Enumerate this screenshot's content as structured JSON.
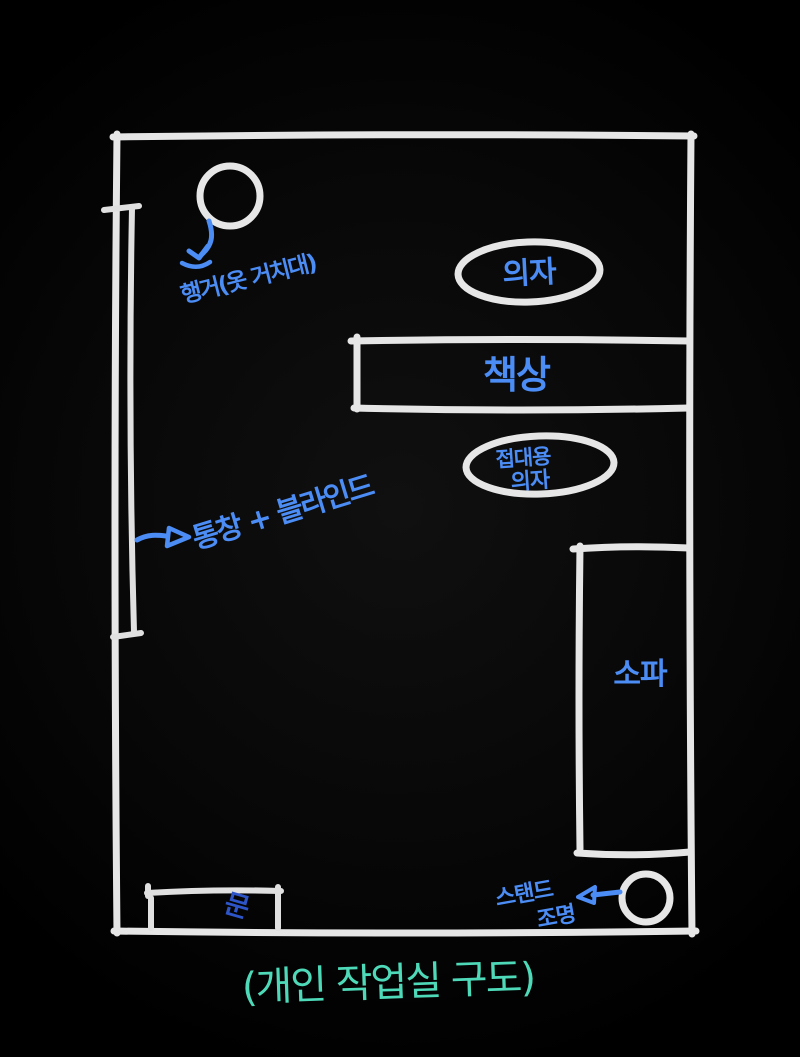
{
  "title": "(개인 작업실 구도)",
  "colors": {
    "background": "#070707",
    "wall_white": "#e6e6e6",
    "label_blue": "#4b8cf5",
    "door_label_blue": "#2e55c8",
    "caption_teal": "#4ed9b8"
  },
  "labels": {
    "hanger": "행거(옷 거치대)",
    "chair": "의자",
    "desk": "책상",
    "guest_chair_line1": "접대용",
    "guest_chair_line2": "의자",
    "window": "통창 + 블라인드",
    "sofa": "소파",
    "door": "문",
    "lamp_line1": "스탠드",
    "lamp_line2": "조명",
    "caption": "(개인 작업실 구도)"
  }
}
